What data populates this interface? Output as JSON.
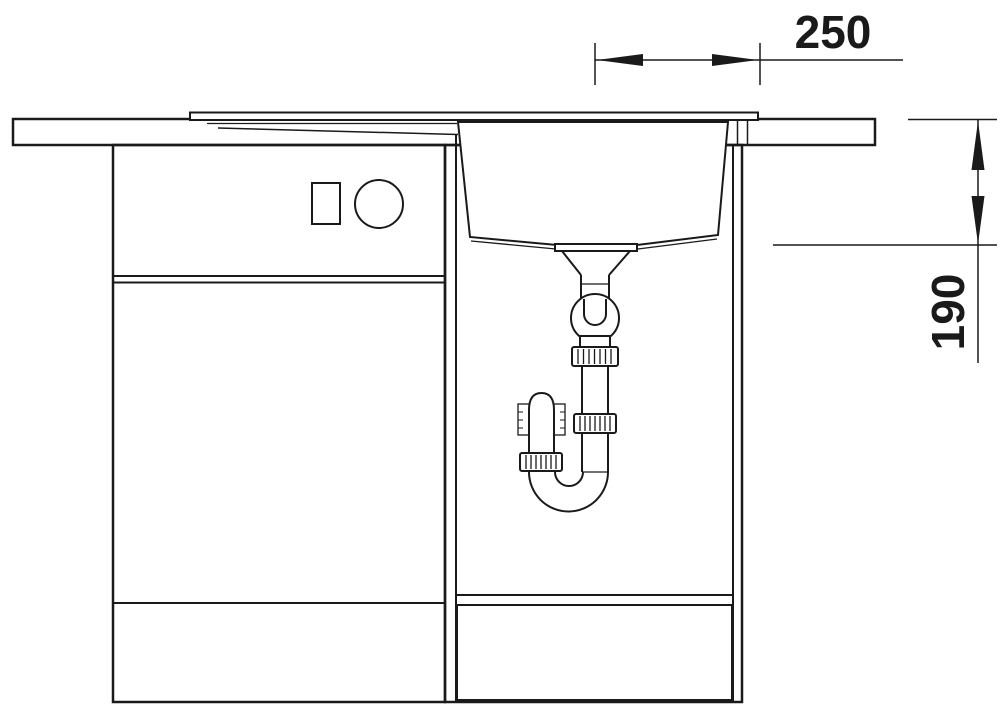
{
  "diagram": {
    "type": "technical-drawing",
    "subject": "kitchen-sink-cabinet-cross-section-with-drain-trap",
    "background_color": "#ffffff",
    "line_color": "#1a1a1a",
    "dimensions": [
      {
        "label": "250",
        "orientation": "horizontal"
      },
      {
        "label": "190",
        "orientation": "vertical"
      }
    ]
  }
}
